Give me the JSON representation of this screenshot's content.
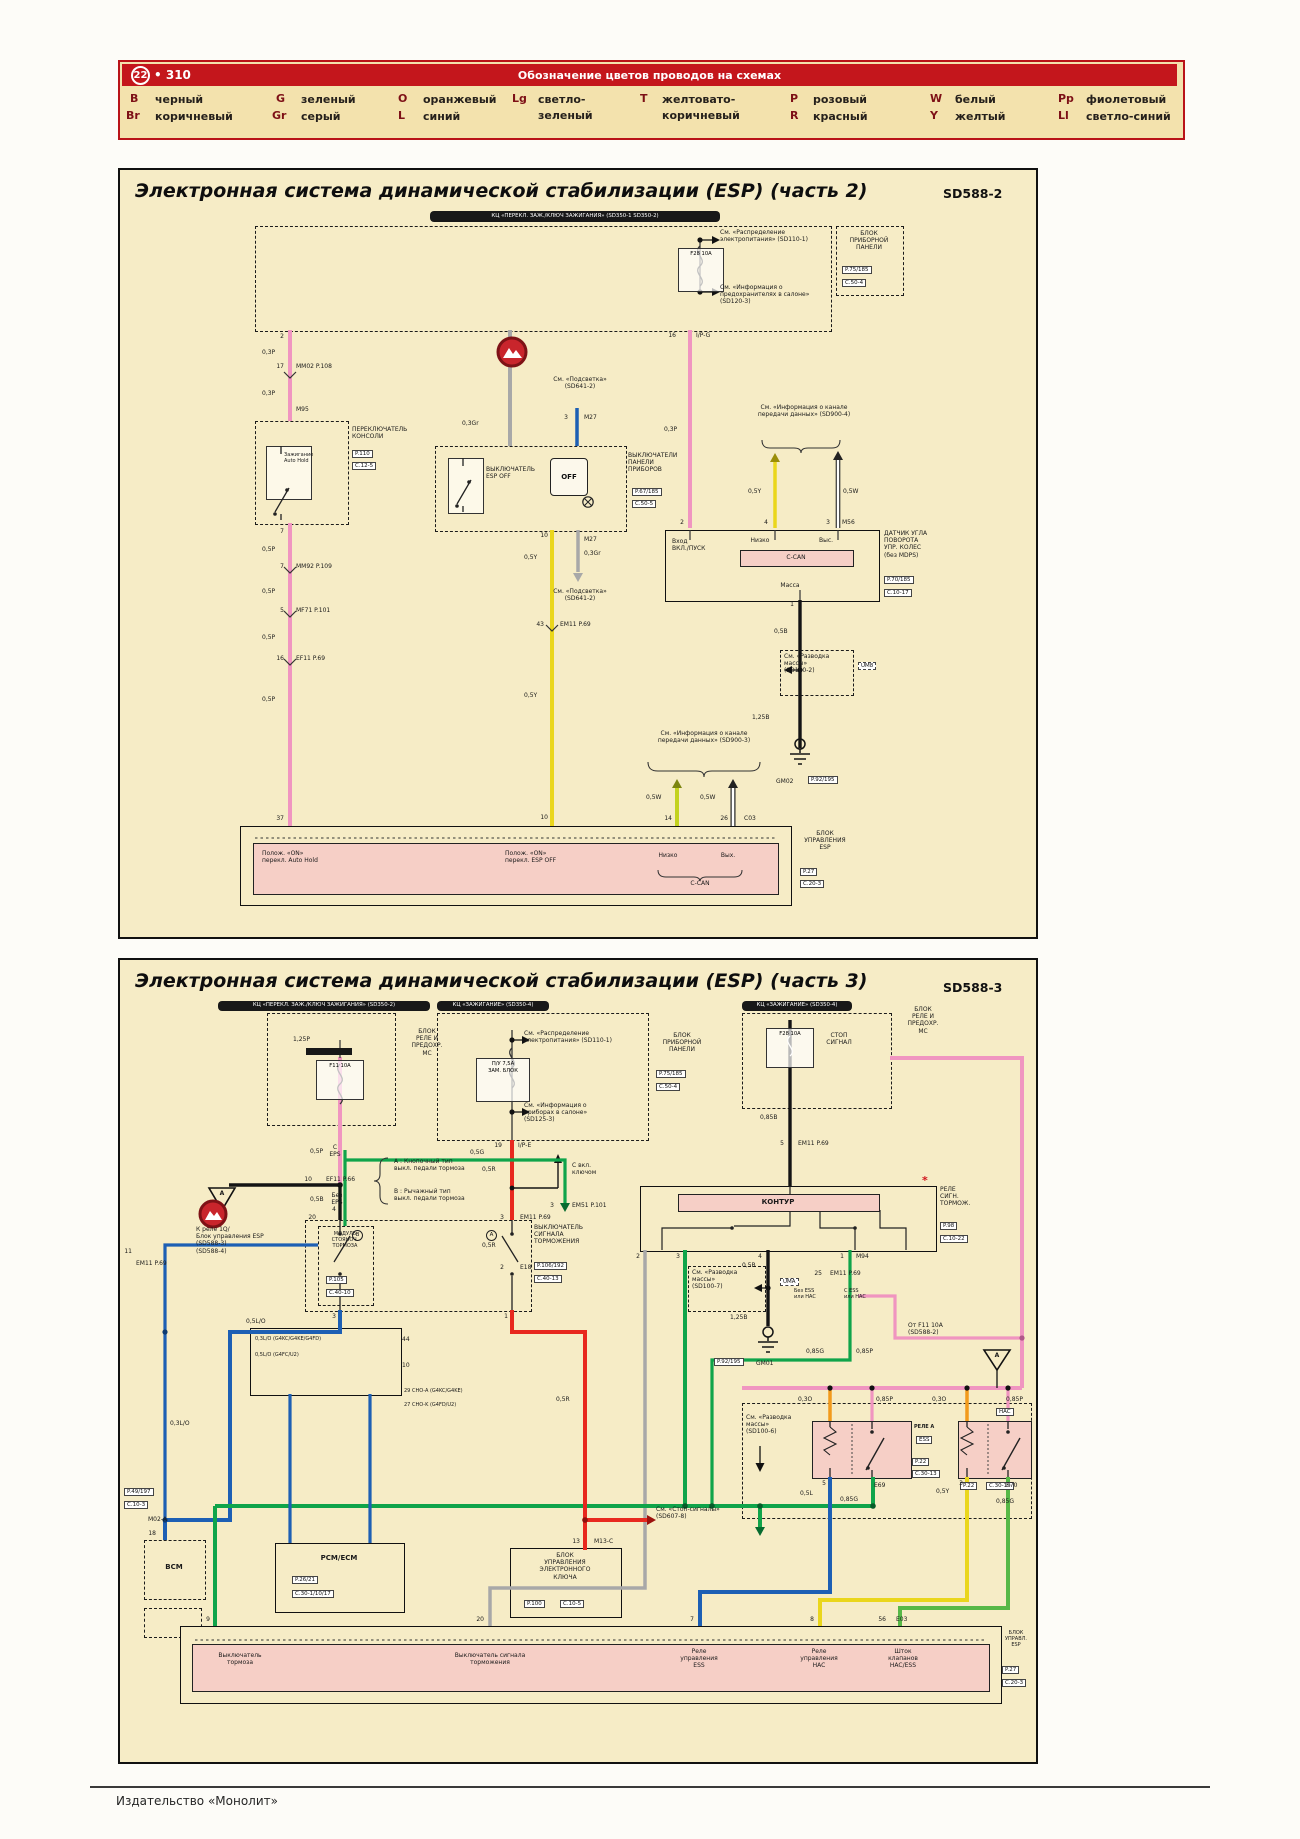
{
  "header": {
    "badge": "22",
    "page": "• 310",
    "title": "Обозначение цветов проводов на схемах"
  },
  "legend": {
    "items": [
      {
        "code": "B",
        "name": "черный"
      },
      {
        "code": "Br",
        "name": "коричневый"
      },
      {
        "code": "G",
        "name": "зеленый"
      },
      {
        "code": "Gr",
        "name": "серый"
      },
      {
        "code": "O",
        "name": "оранжевый"
      },
      {
        "code": "L",
        "name": "синий"
      },
      {
        "code": "Lg",
        "name": "светло-\nзеленый"
      },
      {
        "code": "T",
        "name": "желтовато-\nкоричневый"
      },
      {
        "code": "P",
        "name": "розовый"
      },
      {
        "code": "R",
        "name": "красный"
      },
      {
        "code": "W",
        "name": "белый"
      },
      {
        "code": "Y",
        "name": "желтый"
      },
      {
        "code": "Pp",
        "name": "фиолетовый"
      },
      {
        "code": "Ll",
        "name": "светло-синий"
      }
    ]
  },
  "p1": {
    "title": "Электронная система динамической стабилизации (ESP) (часть 2)",
    "code": "SD588-2",
    "labels": {
      "topbar": "КЦ «ПЕРЕКЛ. ЗАЖ./КЛЮЧ ЗАЖИГАНИЯ» (SD350-1 SD350-2)",
      "see_power": "См. «Распределение\nэлектропитания» (SD110-1)",
      "fuse_f28": "F28 10A",
      "see_fuses": "См. «Информация о\nпредохранителях в салоне»\n(SD120-3)",
      "cluster": "БЛОК\nПРИБОРНОЙ\nПАНЕЛИ",
      "cluster_p": "P.75/185",
      "cluster_c": "C.50-4",
      "pin2": "2",
      "w03p_a": "0,3P",
      "pin17": "17",
      "mm02": "MM02  P.108",
      "w03p_b": "0,3P",
      "m95": "M95",
      "console": "ПЕРЕКЛЮЧАТЕЛЬ\nКОНСОЛИ",
      "console_p": "P.110",
      "console_c": "C.12-5",
      "console_sw": "Зажигание\nAuto Hold",
      "pin7": "7",
      "w05p_a": "0,5P",
      "pin7b": "7",
      "mm92": "MM92  P.109",
      "w05p_b": "0,5P",
      "pin5": "5",
      "mf71": "MF71  P.101",
      "w05p_c": "0,5P",
      "pin16l": "16",
      "ef11": "EF11  P.69",
      "w05p_d": "0,5P",
      "pin37": "37",
      "w03gr_a": "0,3Gr",
      "see_light_top": "См. «Подсветка»\n(SD641-2)",
      "pin3": "3",
      "m27": "M27",
      "espoff": "ВЫКЛЮЧАТЕЛЬ\nESP OFF",
      "off_icon": "OFF",
      "esp_right": "ВЫКЛЮЧАТЕЛИ\nПАНЕЛИ\nПРИБОРОВ",
      "esp_right_p": "P.67/185",
      "esp_right_c": "C.50-5",
      "pin10": "10",
      "w05y_a": "0,5Y",
      "pin43": "43",
      "em11": "EM11  P.69",
      "w05y_b": "0,5Y",
      "pin10b": "10",
      "w03gr_b": "0,3Gr",
      "m27b": "M27",
      "see_light_bot": "См. «Подсветка»\n(SD641-2)",
      "see_can3": "См. «Информация о канале\nпередачи данных» (SD900-3)",
      "w05w_a": "0,5W",
      "w05w_b": "0,5W",
      "pin14": "14",
      "pin26": "26",
      "c03": "C03",
      "bb_auto": "Полож. «ON»\nперекл. Auto Hold",
      "bb_esp": "Полож. «ON»\nперекл. ESP OFF",
      "bb_low": "Низко",
      "bb_out": "Вых.",
      "bb_can": "C-CAN",
      "esp_unit": "БЛОК\nУПРАВЛЕНИЯ\nESP",
      "esp_unit_p": "P.27",
      "esp_unit_c": "C.20-3",
      "pin16r": "16",
      "ipg": "I/P-G",
      "w03p_c": "0,3P",
      "see_can4": "См. «Информация о канале\nпередачи данных» (SD900-4)",
      "w05y_c": "0,5Y",
      "w05w_c": "0,5W",
      "spin2": "2",
      "spin4": "4",
      "spin3": "3",
      "m56": "M56",
      "s_in": "Вход\nВКЛ./ПУСК",
      "s_low": "Низко",
      "s_high": "Выс.",
      "s_can": "C-CAN",
      "s_mass": "Масса",
      "sensor": "ДАТЧИК УГЛА\nПОВОРОТА\nУПР. КОЛЕС\n(без MDPS)",
      "sensor_p": "P.70/185",
      "sensor_c": "C.10-17",
      "spin1": "1",
      "w05b": "0,5B",
      "see_mass2": "См. «Разводка\nмассы»\n(SD100-2)",
      "um8": "UM8",
      "w125b": "1,25B",
      "gm02": "GM02",
      "gm02_p": "P.92/195"
    }
  },
  "p2": {
    "title": "Электронная система динамической стабилизации (ESP) (часть 3)",
    "code": "SD588-3",
    "labels": {
      "bar1": "КЦ «ПЕРЕКЛ. ЗАЖ./КЛЮЧ ЗАЖИГАНИЯ» (SD350-2)",
      "bar2": "КЦ «ЗАЖИГАНИЕ» (SD350-4)",
      "bar3": "КЦ «ЗАЖИГАНИЕ» (SD350-4)",
      "w125p": "1,25P",
      "fuse_f11": "F11 10A",
      "fusebox1": "БЛОК\nРЕЛЕ И\nПРЕДОХР.\nМС",
      "see_power": "См. «Распределение\nэлектропитания» (SD110-1)",
      "fuse_pu": "П/У 7,5А\nЗАМ. БЛОК",
      "see_cabin": "См. «Информация о\nприборах в салоне»\n(SD125-3)",
      "cluster": "БЛОК\nПРИБОРНОЙ\nПАНЕЛИ",
      "cluster_p": "P.75/185",
      "cluster_c": "C.50-4",
      "fuse_f28": "F28 10A",
      "stop_sig": "СТОП\nСИГНАЛ",
      "fusebox2": "БЛОК\nРЕЛЕ И\nПРЕДОХР.\nМС",
      "w05p": "0,5P",
      "w05b_a": "0,5B",
      "tri_a1": "A",
      "to_relay": "К реле 1Q/\nБлок управления ESP\n(SD588-3)\n(SD588-4)",
      "note_a": "А : Кнопочный тип\nвыкл. педали тормоза",
      "note_b": "В : Рычажный тип\nвыкл. педали тормоза",
      "pin19": "19",
      "ipe": "I/P-E",
      "w05r_a": "0,5R",
      "pin3r": "3",
      "em11_3": "EM11  P.69",
      "w05r_b": "0,5R",
      "pin2r": "2",
      "e18": "E18",
      "brake_sw": "ВЫКЛЮЧАТЕЛЬ\nСИГНАЛА\nТОРМОЖЕНИЯ",
      "brake_p": "P.106/192",
      "brake_c": "C.40-13",
      "pin4": "4",
      "pin3s": "3",
      "pin1s": "1",
      "circ_a": "А",
      "circ_b": "В",
      "c_eps": "С\nEPS",
      "pin10e": "10",
      "ef11": "EF11  P.66",
      "no_eps": "Без\nEPS",
      "pin20": "20",
      "module": "МОДУЛЬ\nСТОЯНОЧ.\nТОРМОЗА",
      "module_p": "P.105",
      "module_c": "C.40-10",
      "w05g_a": "0,5G",
      "key_on": "С вкл.\nключом",
      "pin3g": "3",
      "em51": "EM51  P.101",
      "w085b": "0,85B",
      "pin5e": "5",
      "em11_5": "EM11  P.69",
      "kontur": "КОНТУР",
      "star": "*",
      "b_relay": "РЕЛЕ\nСИГН.\nТОРМОЖ.",
      "b_relay_p": "P.98",
      "b_relay_c": "C.10-22",
      "kpin2": "2",
      "kpin3": "3",
      "kpin4": "4",
      "kpin1": "1",
      "m94": "M94",
      "w05b_b": "0,5B",
      "see_mass7": "См. «Разводка\nмассы»\n(SD100-7)",
      "uma": "UMA",
      "w125b": "1,25B",
      "gm01": "GM01",
      "gm01_p": "P.92/195",
      "pin25": "25",
      "em11_25": "EM11  P.69",
      "no_ess": "Без ESS\nили HAC",
      "with_ess": "С ESS\nили HAC",
      "w085g_a": "0,85G",
      "w085p_a": "0,85P",
      "from_f11": "От F11 10A\n(SD588-2)",
      "tri_a2": "A",
      "see_mass6": "См. «Разводка\nмассы»\n(SD100-6)",
      "w03o_a": "0,3O",
      "w03o_b": "0,3O",
      "w085p_b": "0,85P",
      "w085p_c": "0,85P",
      "relay_a": "РЕЛЕ А",
      "ess": "ESS",
      "ess_p": "P.22",
      "ess_c": "C.30-13",
      "hac": "HAC",
      "hac_p": "P.22",
      "hac_c": "C.30-19",
      "e69": "E69",
      "e70": "E70",
      "pin5r": "5",
      "pin3rr": "3",
      "w05l": "0,5L",
      "w085g_b": "0,85G",
      "w05y": "0,5Y",
      "w085g_c": "0,85G",
      "see_stop": "См. «Стоп-сигналы»\n(SD607-8)",
      "pin13": "13",
      "m13c": "M13-C",
      "w05r_c": "0,5R",
      "m02a_l1": "0,3L/О (G4KC/G4KE/G4FD)",
      "m02a_l2": "0,5L/О (G4FC/U2)",
      "pin44": "44",
      "pin10m": "10",
      "cho_a": "29  CHO-A (G4KC/G4KE)",
      "cho_k": "27  CHO-K (G4FD/U2)",
      "pcm": "PCM/ECM",
      "pcm_p": "P.26/21",
      "pcm_c": "C.30-1/10/17",
      "keybox": "БЛОК\nУПРАВЛЕНИЯ\nЭЛЕКТРОННОГО\nКЛЮЧА",
      "key_p": "P.100",
      "key_c": "C.10-5",
      "m02a_p": "P.49/197",
      "m02a_c": "C.10-3",
      "m02a": "M02-A",
      "pin18": "18",
      "bcm": "BCM",
      "pin11": "11",
      "em11_11": "EM11  P.69",
      "w03lo": "0,3L/О",
      "w05lo": "0,5L/О",
      "bpin9": "9",
      "bpin20": "20",
      "bpin7": "7",
      "bpin8": "8",
      "bpin56": "56",
      "e03": "E03",
      "bb1": "Выключатель\nтормоза",
      "bb2": "Выключатель сигнала\nторможения",
      "bb3": "Реле\nуправления\nESS",
      "bb4": "Реле\nуправления\nHAC",
      "bb5": "Шток\nклапанов\nHAC/ESS",
      "esp_unit": "БЛОК\nУПРАВЛ.\nESP",
      "esp_unit_p": "P.27",
      "esp_unit_c": "C.20-3"
    }
  },
  "footer": {
    "publisher": "Издательство «Монолит»"
  }
}
